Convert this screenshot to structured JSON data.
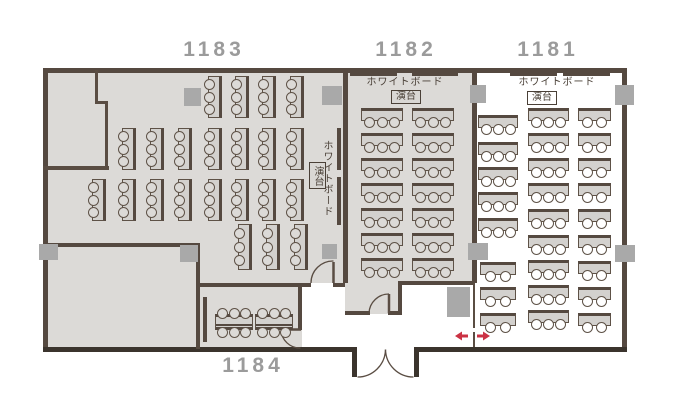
{
  "rooms": {
    "r1183": {
      "number": "1183",
      "whiteboard_label": "ホワイトボード",
      "lectern_label": "演台"
    },
    "r1182": {
      "number": "1182",
      "whiteboard_label": "ホワイトボード",
      "lectern_label": "演台"
    },
    "r1181": {
      "number": "1181",
      "whiteboard_label": "ホワイトボード",
      "lectern_label": "演台"
    },
    "r1184": {
      "number": "1184"
    }
  },
  "colors": {
    "floor": "#dcdad7",
    "wall": "#554940",
    "pillar": "#a9a9a9",
    "room_label": "#9b9b9b",
    "partition_arrow": "#cb3244",
    "table_fill": "#d3d1ce",
    "room_1181_floor": "#ffffff"
  },
  "plan": {
    "pillars": [
      {
        "x": 184,
        "y": 88,
        "w": 17,
        "h": 18
      },
      {
        "x": 322,
        "y": 86,
        "w": 20,
        "h": 19
      },
      {
        "x": 470,
        "y": 85,
        "w": 16,
        "h": 18
      },
      {
        "x": 615,
        "y": 85,
        "w": 19,
        "h": 20
      },
      {
        "x": 39,
        "y": 244,
        "w": 19,
        "h": 16
      },
      {
        "x": 180,
        "y": 245,
        "w": 18,
        "h": 17
      },
      {
        "x": 322,
        "y": 244,
        "w": 15,
        "h": 15
      },
      {
        "x": 468,
        "y": 243,
        "w": 20,
        "h": 17
      },
      {
        "x": 615,
        "y": 245,
        "w": 20,
        "h": 17
      },
      {
        "x": 447,
        "y": 287,
        "w": 23,
        "h": 30
      }
    ],
    "whiteboard_bars": [
      [
        350,
        72,
        47,
        4
      ],
      [
        412,
        72,
        46,
        4
      ],
      [
        510,
        72,
        47,
        4
      ],
      [
        563,
        72,
        47,
        4
      ],
      [
        337,
        128,
        4,
        42
      ],
      [
        337,
        177,
        4,
        48
      ],
      [
        203,
        297,
        4,
        45
      ]
    ],
    "table_groups": [
      {
        "room": "1183",
        "type": "v",
        "w": 14,
        "h": 42,
        "seats": 3,
        "chair_fill": "#dcdad7",
        "rows": [
          {
            "y": 76,
            "x": [
              208,
              235,
              262,
              290
            ]
          },
          {
            "y": 128,
            "x": [
              122,
              150,
              178,
              208,
              235,
              262,
              290
            ]
          },
          {
            "y": 179,
            "x": [
              92,
              122,
              150,
              178,
              208,
              235,
              262,
              290
            ]
          },
          {
            "y": 224,
            "h": 46,
            "x": [
              238,
              266,
              294
            ]
          }
        ]
      },
      {
        "room": "1182",
        "type": "h",
        "w": 42,
        "h": 13,
        "seats": 3,
        "chair_fill": "#dcdad7",
        "rows": [
          {
            "y": 108,
            "x": [
              361,
              412
            ]
          },
          {
            "y": 133,
            "x": [
              361,
              412
            ]
          },
          {
            "y": 158,
            "x": [
              361,
              412
            ]
          },
          {
            "y": 183,
            "x": [
              361,
              412
            ]
          },
          {
            "y": 208,
            "x": [
              361,
              412
            ]
          },
          {
            "y": 233,
            "x": [
              361,
              412
            ]
          },
          {
            "y": 258,
            "x": [
              361,
              412
            ]
          }
        ]
      },
      {
        "room": "1181",
        "type": "h",
        "w": 41,
        "h": 13,
        "seats": 3,
        "chair_fill": "#ffffff",
        "rows": [
          {
            "y": 108,
            "x": [
              528
            ]
          },
          {
            "y": 133,
            "x": [
              528
            ]
          },
          {
            "y": 158,
            "x": [
              528
            ]
          },
          {
            "y": 183,
            "x": [
              528
            ]
          },
          {
            "y": 209,
            "x": [
              528
            ]
          },
          {
            "y": 235,
            "x": [
              528
            ]
          },
          {
            "y": 260,
            "x": [
              528
            ]
          },
          {
            "y": 285,
            "x": [
              528
            ]
          },
          {
            "y": 310,
            "x": [
              528
            ]
          }
        ]
      },
      {
        "room": "1181",
        "type": "h",
        "w": 33,
        "h": 13,
        "seats": 2,
        "chair_fill": "#ffffff",
        "rows": [
          {
            "y": 108,
            "x": [
              578
            ]
          },
          {
            "y": 133,
            "x": [
              578
            ]
          },
          {
            "y": 158,
            "x": [
              578
            ]
          },
          {
            "y": 183,
            "x": [
              578
            ]
          },
          {
            "y": 209,
            "x": [
              578
            ]
          },
          {
            "y": 235,
            "x": [
              578
            ]
          },
          {
            "y": 261,
            "x": [
              578
            ]
          },
          {
            "y": 287,
            "x": [
              578
            ]
          },
          {
            "y": 313,
            "x": [
              578
            ]
          }
        ]
      },
      {
        "room": "1181",
        "type": "h",
        "w": 40,
        "h": 13,
        "seats": 3,
        "chair_fill": "#ffffff",
        "rows": [
          {
            "y": 115,
            "x": [
              478
            ]
          },
          {
            "y": 142,
            "x": [
              478
            ]
          },
          {
            "y": 167,
            "x": [
              478
            ]
          },
          {
            "y": 192,
            "x": [
              478
            ]
          },
          {
            "y": 218,
            "x": [
              478
            ]
          }
        ]
      },
      {
        "room": "1181",
        "type": "h",
        "w": 36,
        "h": 13,
        "seats": 2,
        "chair_fill": "#ffffff",
        "rows": [
          {
            "y": 262,
            "x": [
              480
            ]
          },
          {
            "y": 287,
            "x": [
              480
            ]
          },
          {
            "y": 313,
            "x": [
              480
            ]
          }
        ]
      },
      {
        "room": "1184",
        "type": "pair",
        "w": 38,
        "h": 16,
        "seats": 3,
        "chair_fill": "#dcdad7",
        "rows": [
          {
            "y": 314,
            "x": [
              215,
              255
            ]
          }
        ]
      }
    ]
  }
}
